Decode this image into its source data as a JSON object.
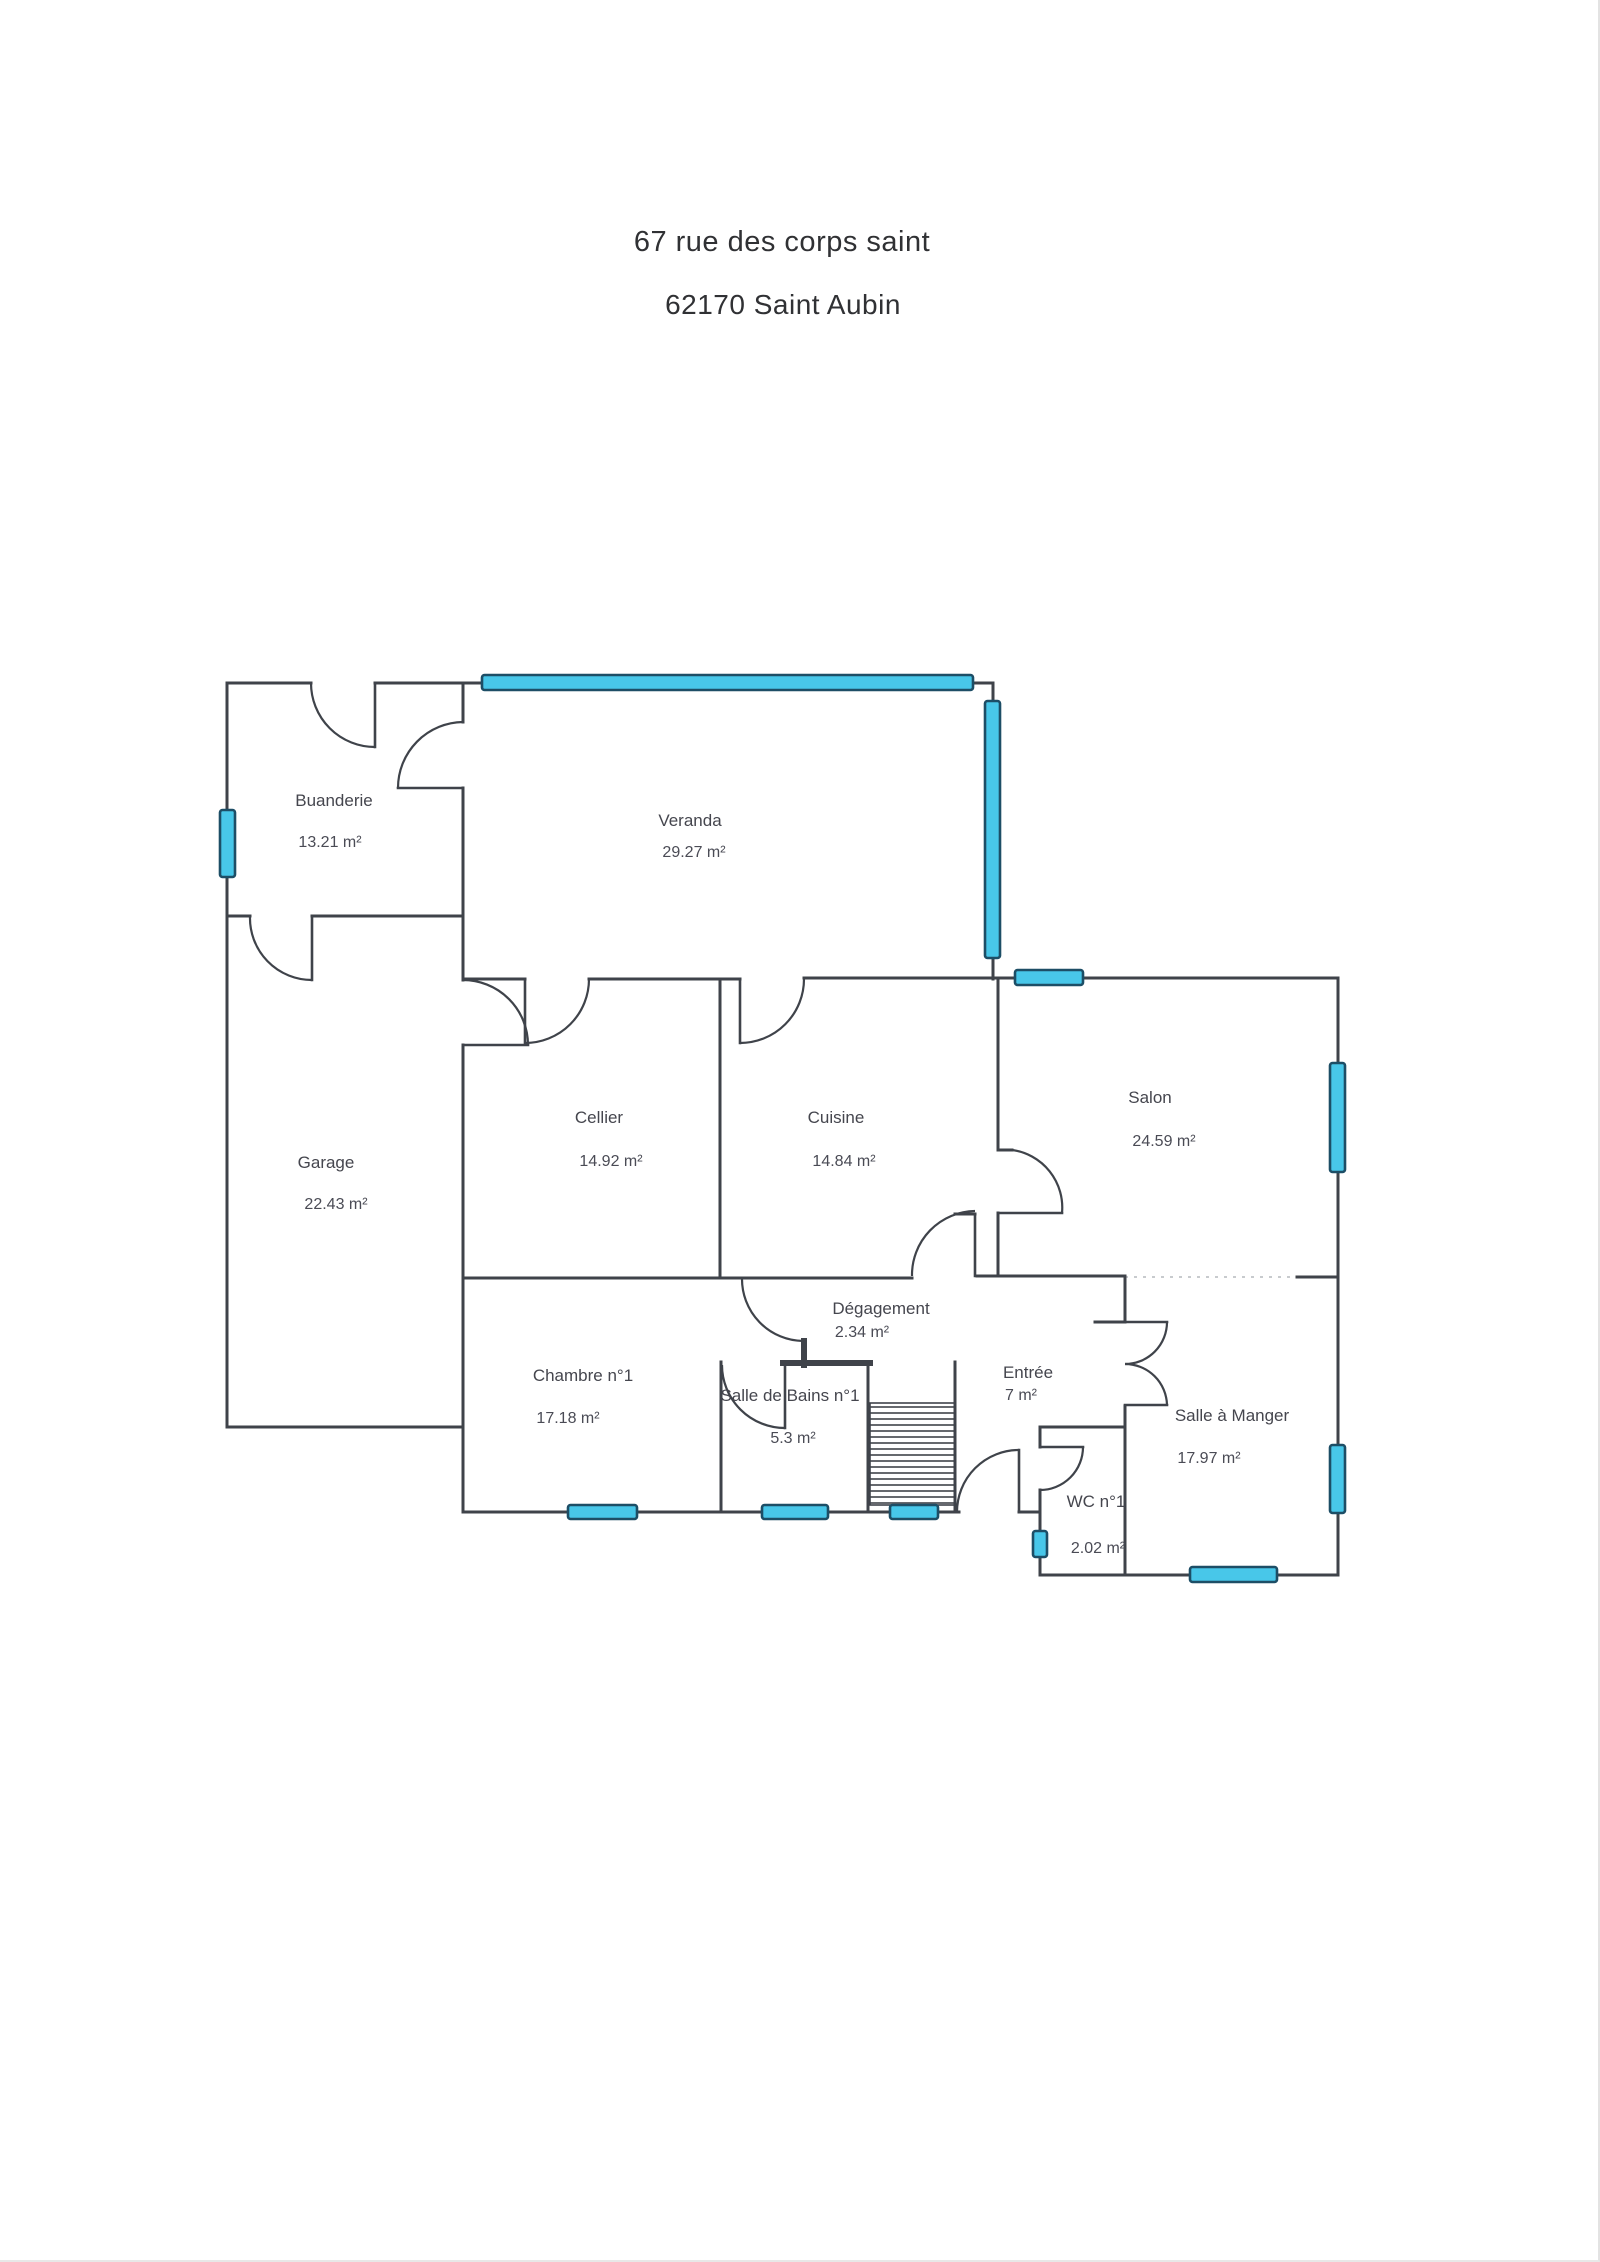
{
  "page": {
    "title_line1": "67 rue des corps saint",
    "title_line2": "62170 Saint Aubin"
  },
  "plan": {
    "rooms": [
      {
        "id": "buanderie",
        "name": "Buanderie",
        "area": "13.21 m²",
        "nx": 334,
        "ny": 806,
        "ax": 330,
        "ay": 847
      },
      {
        "id": "veranda",
        "name": "Veranda",
        "area": "29.27 m²",
        "nx": 690,
        "ny": 826,
        "ax": 694,
        "ay": 857
      },
      {
        "id": "garage",
        "name": "Garage",
        "area": "22.43 m²",
        "nx": 326,
        "ny": 1168,
        "ax": 336,
        "ay": 1209
      },
      {
        "id": "cellier",
        "name": "Cellier",
        "area": "14.92 m²",
        "nx": 599,
        "ny": 1123,
        "ax": 611,
        "ay": 1166
      },
      {
        "id": "cuisine",
        "name": "Cuisine",
        "area": "14.84 m²",
        "nx": 836,
        "ny": 1123,
        "ax": 844,
        "ay": 1166
      },
      {
        "id": "salon",
        "name": "Salon",
        "area": "24.59 m²",
        "nx": 1150,
        "ny": 1103,
        "ax": 1164,
        "ay": 1146
      },
      {
        "id": "chambre-1",
        "name": "Chambre n°1",
        "area": "17.18 m²",
        "nx": 583,
        "ny": 1381,
        "ax": 568,
        "ay": 1423
      },
      {
        "id": "salle-de-bains-1",
        "name": "Salle de Bains n°1",
        "area": "5.3 m²",
        "nx": 790,
        "ny": 1401,
        "ax": 793,
        "ay": 1443
      },
      {
        "id": "degagement",
        "name": "Dégagement",
        "area": "2.34 m²",
        "nx": 881,
        "ny": 1314,
        "ax": 862,
        "ay": 1337
      },
      {
        "id": "entree",
        "name": "Entrée",
        "area": "7 m²",
        "nx": 1028,
        "ny": 1378,
        "ax": 1021,
        "ay": 1400
      },
      {
        "id": "wc-1",
        "name": "WC n°1",
        "area": "2.02 m²",
        "nx": 1096,
        "ny": 1507,
        "ax": 1098,
        "ay": 1553
      },
      {
        "id": "salle-a-manger",
        "name": "Salle à Manger",
        "area": "17.97 m²",
        "nx": 1232,
        "ny": 1421,
        "ax": 1209,
        "ay": 1463
      }
    ],
    "windows": [
      {
        "id": "window-veranda-top",
        "x": 482,
        "y": 675,
        "w": 491,
        "h": 15
      },
      {
        "id": "window-veranda-right",
        "x": 985,
        "y": 701,
        "w": 15,
        "h": 257
      },
      {
        "id": "window-buanderie-left",
        "x": 220,
        "y": 810,
        "w": 15,
        "h": 67
      },
      {
        "id": "window-salon-top",
        "x": 1015,
        "y": 970,
        "w": 68,
        "h": 15
      },
      {
        "id": "window-salon-right",
        "x": 1330,
        "y": 1063,
        "w": 15,
        "h": 109
      },
      {
        "id": "window-salle-a-manger-right",
        "x": 1330,
        "y": 1445,
        "w": 15,
        "h": 68
      },
      {
        "id": "window-salle-a-manger-bottom",
        "x": 1190,
        "y": 1567,
        "w": 87,
        "h": 15
      },
      {
        "id": "window-wc-left",
        "x": 1033,
        "y": 1531,
        "w": 14,
        "h": 26
      },
      {
        "id": "window-chambre-bottom",
        "x": 568,
        "y": 1505,
        "w": 69,
        "h": 14
      },
      {
        "id": "window-salle-de-bains-bottom",
        "x": 762,
        "y": 1505,
        "w": 66,
        "h": 14
      },
      {
        "id": "window-stairs-bottom",
        "x": 890,
        "y": 1505,
        "w": 48,
        "h": 14
      }
    ],
    "colors": {
      "wall": "#3f434a",
      "text": "#45464e",
      "window_fill": "#48c7e9",
      "window_stroke": "#1d4e66"
    }
  }
}
